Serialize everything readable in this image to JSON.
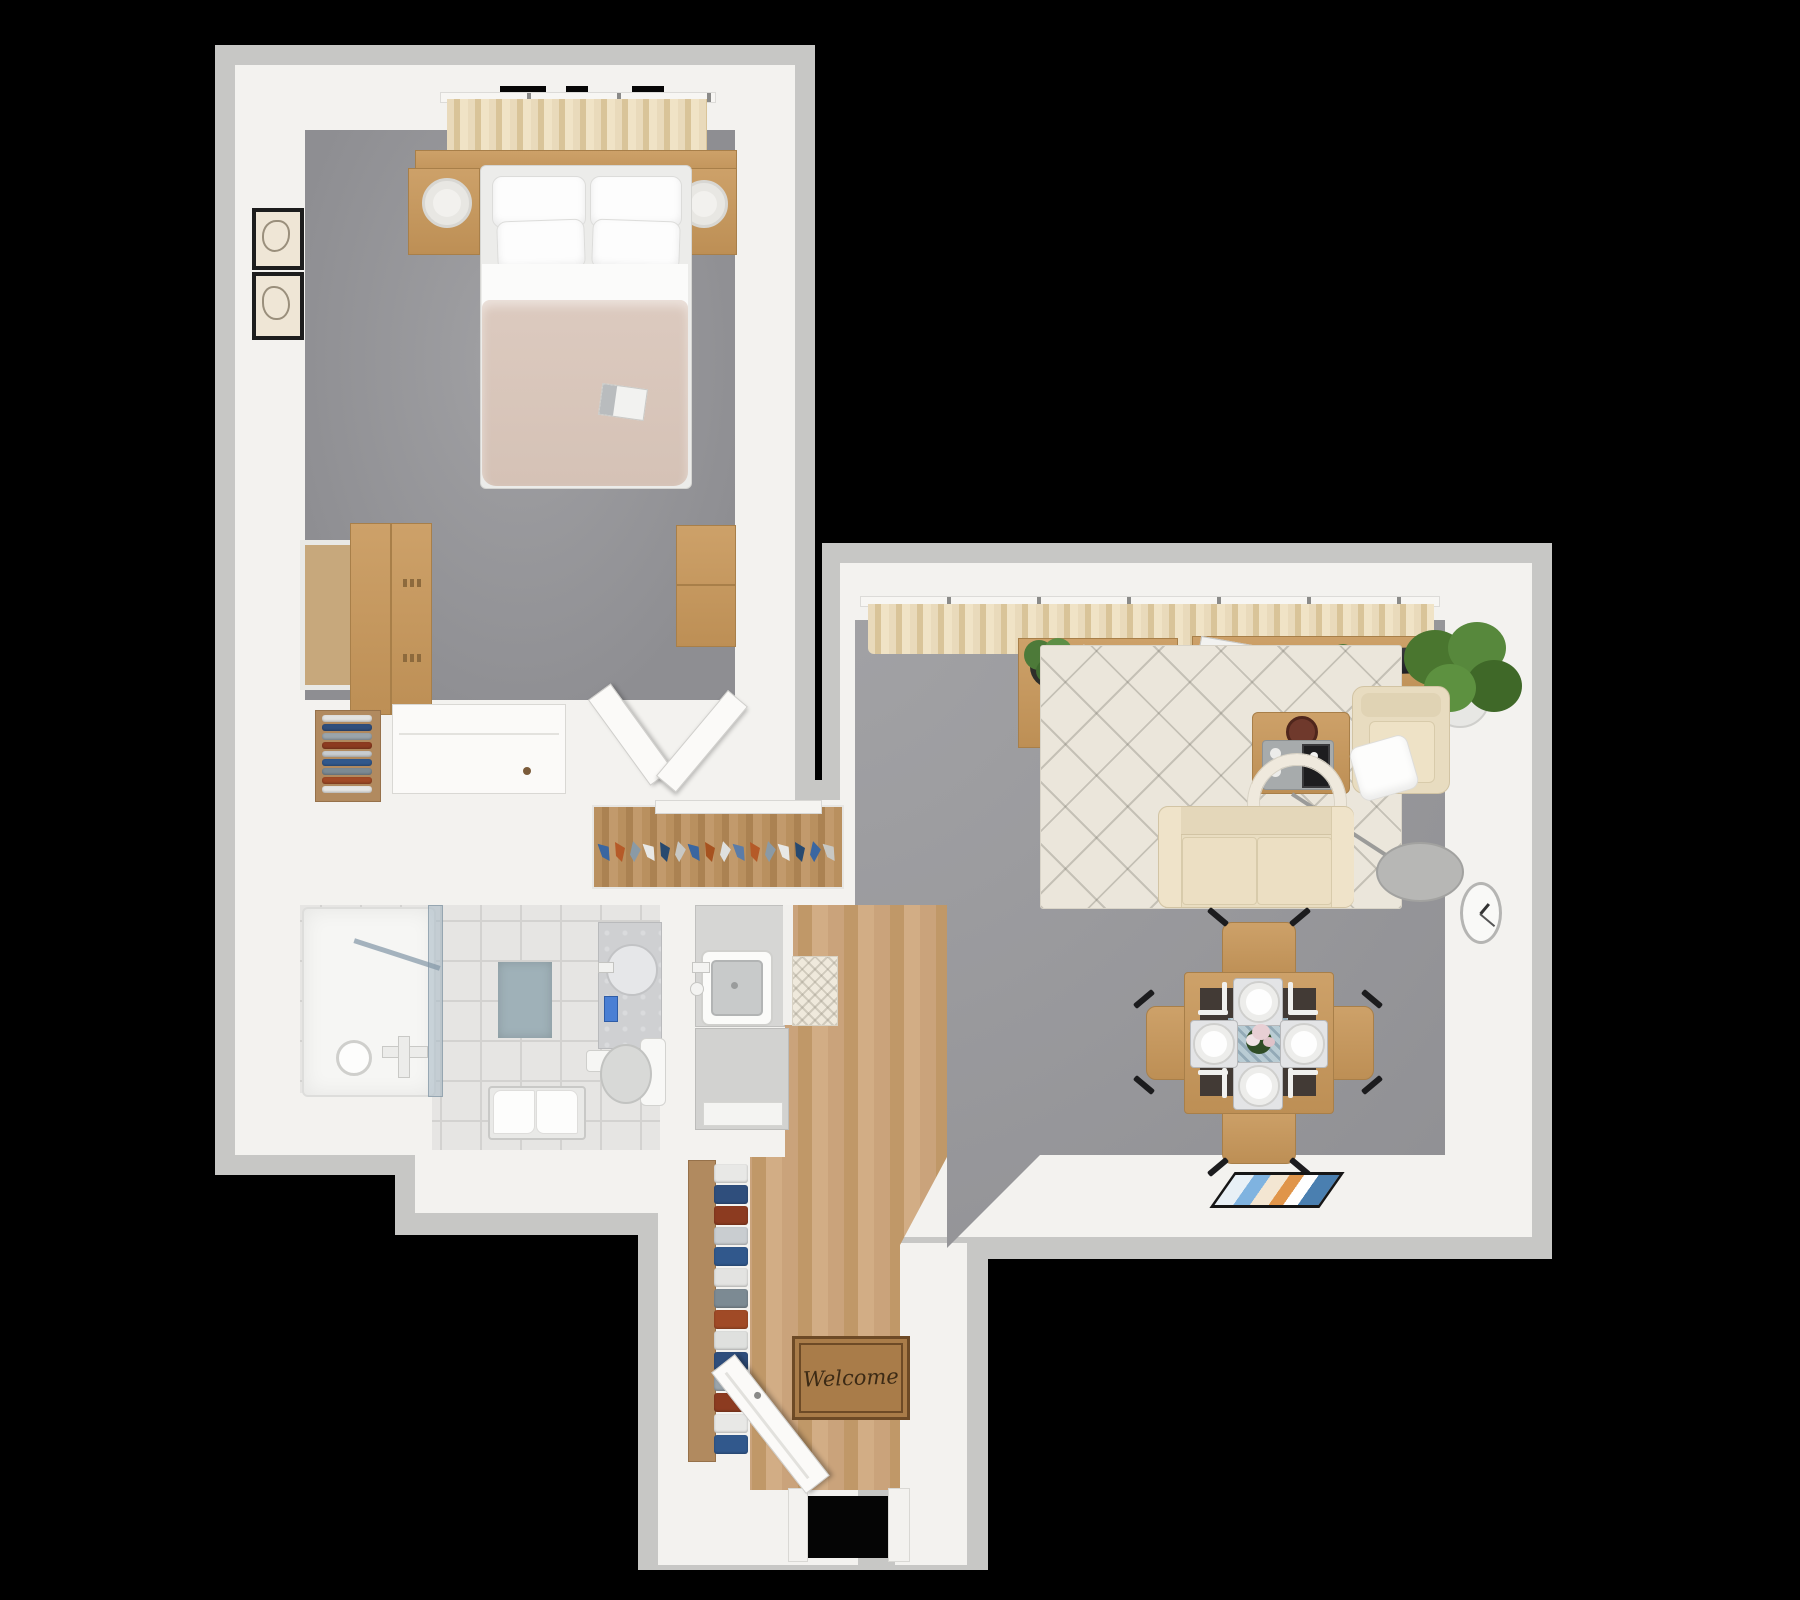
{
  "scene": {
    "type": "3d-floorplan-top-down-render",
    "background": "#000000",
    "welcome_mat_text": "Welcome",
    "magazine_label": "XMAX"
  },
  "palette": {
    "wall_white": "#f3f2ef",
    "wall_outer_gray": "#c7c7c5",
    "carpet_gray": "#95959a",
    "wood_floor": "#c49b6e",
    "tile_floor": "#e6e5e3",
    "beige_fabric": "#e8dcc2",
    "curtain_beige": "#e4d2ab",
    "furniture_wood": "#c59a62",
    "duvet_blush": "#d9c7bc",
    "bath_mat_blue": "#9fb1b8",
    "tv_black": "#26262a"
  },
  "rooms": {
    "bedroom": {
      "label": "Bedroom",
      "floor": "gray carpet",
      "furniture": [
        "double bed with four pillows and blush duvet",
        "magazine on bed",
        "two wood floating nightstands",
        "two white cylinder table lamps",
        "beige window curtains",
        "two black framed wall art prints",
        "leaning mirror",
        "wood wardrobe",
        "wood dresser",
        "open white door"
      ]
    },
    "walk_in_closet": {
      "label": "Walk-in closet",
      "furniture": [
        "wood shelf with folded clothes",
        "white drawer cabinet",
        "open white closet door",
        "hanging rail with colorful clothes on hangers"
      ]
    },
    "bathroom": {
      "label": "Bathroom",
      "floor": "light tile",
      "furniture": [
        "glass shower enclosure with fixtures",
        "blue bath mat",
        "stone top vanity with round basin and blue soap pump",
        "toilet with tank",
        "toilet paper holder",
        "towel bench with white towels"
      ]
    },
    "kitchen": {
      "label": "Kitchen",
      "floor": "wood planks",
      "furniture": [
        "counter with square sink and faucet",
        "refrigerator",
        "patterned kitchen mat"
      ]
    },
    "hallway": {
      "label": "Entry hall",
      "floor": "wood planks",
      "mat_text": "Welcome",
      "furniture": [
        "tall shelf with folded linens",
        "welcome door mat",
        "open white front door"
      ]
    },
    "living_room": {
      "label": "Living room",
      "floor": "gray carpet",
      "furniture": [
        "beige curtains along window wall",
        "wood desk with laptop, plant and cup",
        "beige office chair",
        "wood TV console with flat TV, magazines and small plant",
        "large potted plant",
        "cream diamond-pattern rug",
        "wood coffee table with bowl and serving tray",
        "arc floor lamp with ring shade",
        "beige two-seat sofa",
        "beige armchair with white pillow",
        "wall clock",
        "framed picture lying by wall"
      ]
    },
    "dining_area": {
      "label": "Dining area",
      "furniture": [
        "square wood dining table with dark runner",
        "four place settings with plates and cutlery",
        "flower centerpiece on blue runner",
        "four wood dining chairs"
      ]
    }
  },
  "hanging_closet": {
    "hanger_colors": [
      "#3a66a0",
      "#b55a28",
      "#8a9aa6",
      "#e8e8e6",
      "#27496f",
      "#c8c8c4",
      "#3a66a0",
      "#a6521f",
      "#dfe0de",
      "#5b7ca8",
      "#b55a28",
      "#8a9aa6",
      "#e8e8e6",
      "#27496f",
      "#3a66a0",
      "#c8c8c4"
    ]
  },
  "shelf_clothes_colors": [
    "#e3e3e1",
    "#2f4e7c",
    "#9aa4ab",
    "#8c3b20",
    "#c9cdd0",
    "#31588c",
    "#7c8a93",
    "#a04a26",
    "#e6e6e4"
  ],
  "entry_clothes_colors": [
    "#e8e8e6",
    "#2f4e7c",
    "#8c3b20",
    "#c9cdd0",
    "#31588c",
    "#e3e3e1",
    "#7c8a93",
    "#a04a26",
    "#dfe0de",
    "#2f4e7c",
    "#9aa4ab",
    "#8c3b20",
    "#e8e8e6",
    "#31588c"
  ]
}
